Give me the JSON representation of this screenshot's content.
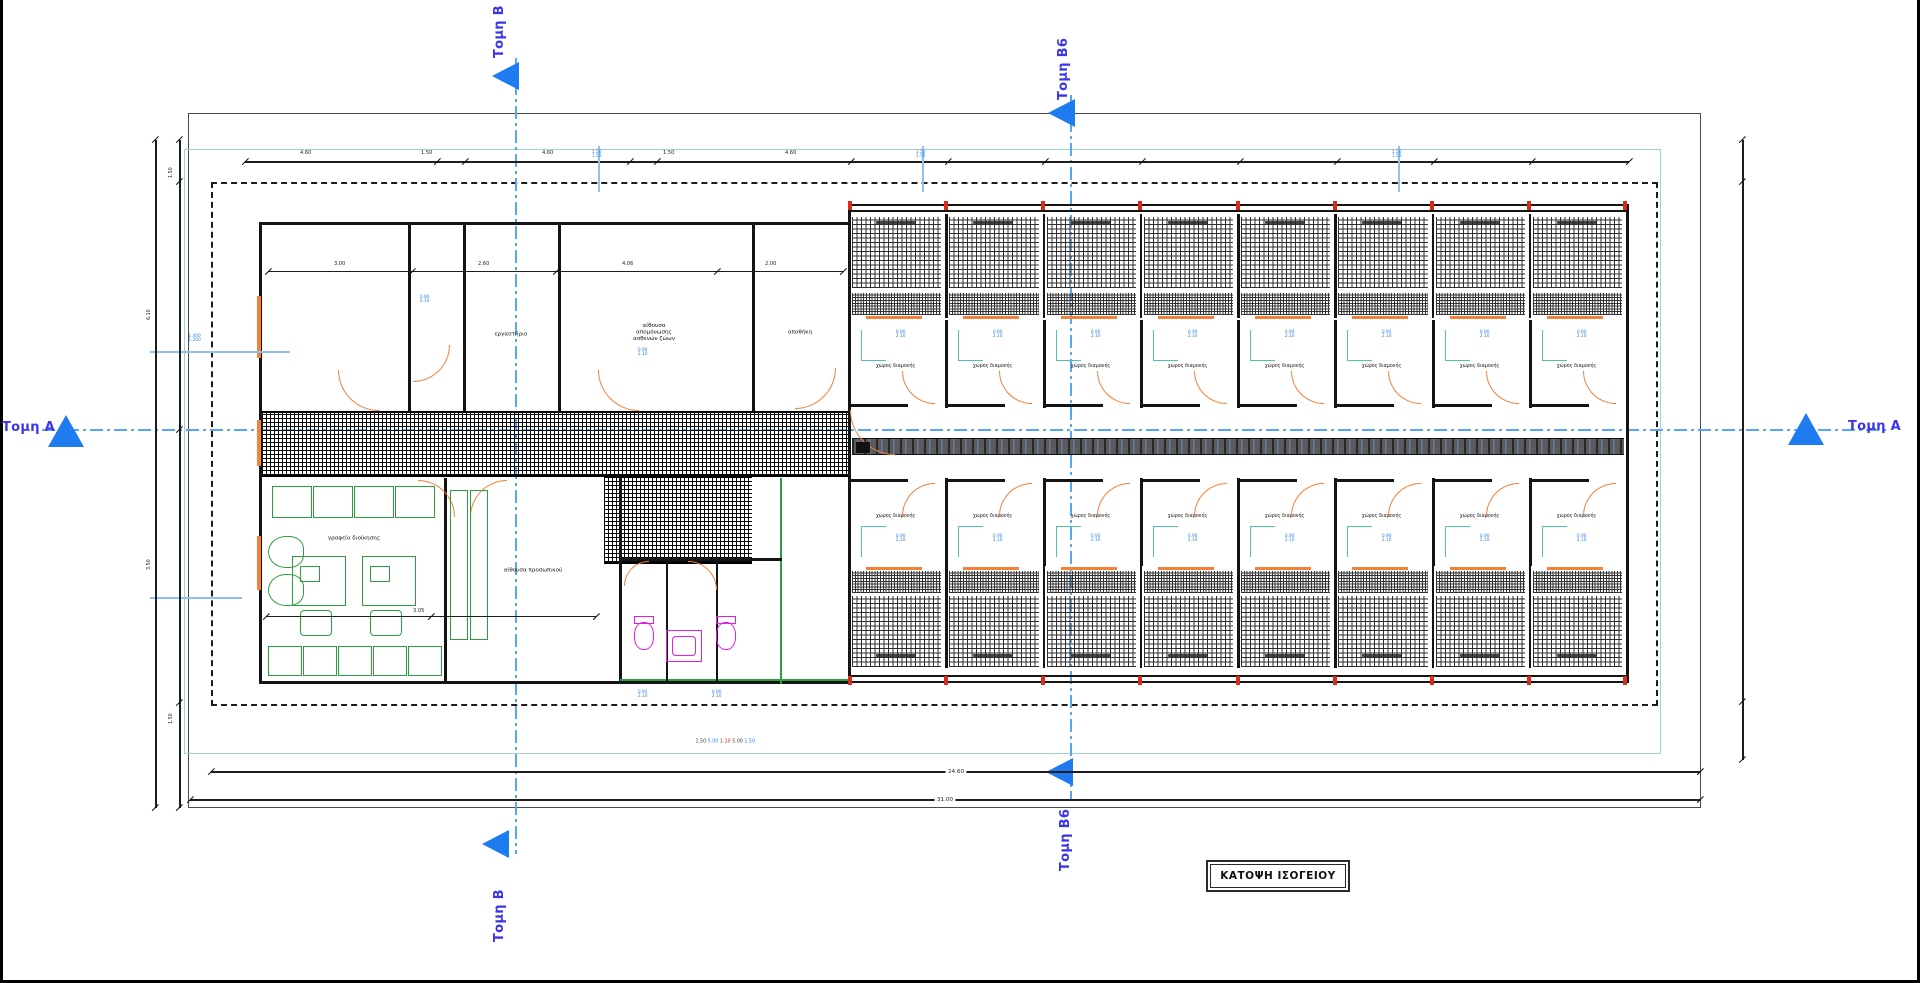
{
  "title_block": {
    "label": "ΚΑΤΟΨΗ ΙΣΟΓΕΙΟΥ"
  },
  "section_markers": {
    "top": "Τομη Β",
    "top_mid": "Τομη Β6",
    "left": "Τομη Α",
    "right": "Τομη Α",
    "bottom_mid": "Τομη Β6",
    "bottom": "Τομη Β"
  },
  "rooms": {
    "lab": "εργαστήριο",
    "isolation": [
      "αίθουσα",
      "απομόνωσης",
      "ασθενών ζώων"
    ],
    "storage": "αποθήκη",
    "admin_office": "γραφείο διοίκησης",
    "staff_room": "αίθουσα προσωπικού"
  },
  "kennel": {
    "units_per_row": 8,
    "rows": 2,
    "room_label": "χώρος διαμονής",
    "door_dim": [
      "0.90",
      "2.10"
    ]
  },
  "dimensions": {
    "top_segments": [
      "4.60",
      "1.50",
      "4.60",
      "1.50",
      "4.60"
    ],
    "upper_interior": [
      "3.00",
      "2.60",
      "4.06",
      "2.00"
    ],
    "office_width": "3.05",
    "window_dim": [
      "1.400",
      "1.200"
    ],
    "door_dim": [
      "0.90",
      "2.10"
    ],
    "axis_ticks": [
      "1.50",
      "1.50"
    ],
    "corridor_chain": [
      "1.50",
      "5.00",
      "1.10",
      "5.00",
      "1.50"
    ],
    "left_segments": [
      "1.50",
      "6.10",
      "3.50",
      "1.50"
    ],
    "total_inner": "24.60",
    "total_outer": "31.00"
  },
  "colors": {
    "section_arrow_blue": "#1f7cf0",
    "section_label_blue": "#3b35ea",
    "boundary_teal": "#9fd6c8",
    "pipe_teal": "#4ec3ad",
    "door_orange": "#f4803c",
    "furniture_green": "#2e9e40",
    "fixture_magenta": "#e619e6",
    "junction_red": "#d92b1c",
    "dimension_blue": "#2f7fe8"
  }
}
